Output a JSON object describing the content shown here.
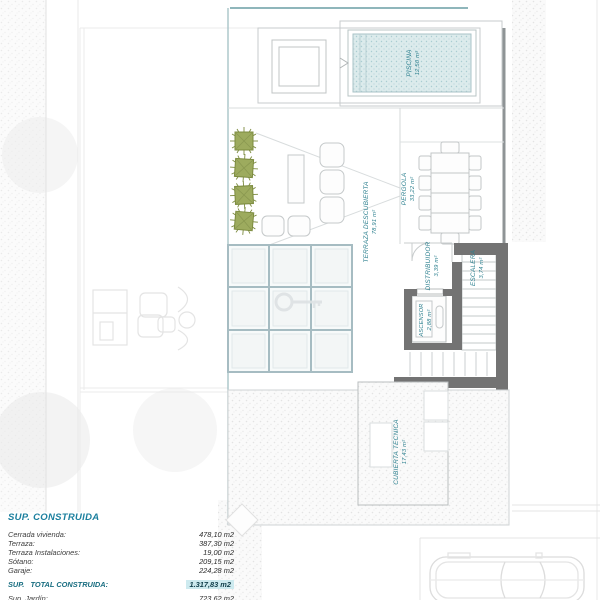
{
  "document": {
    "type": "architectural-roof-floor-plan"
  },
  "colors": {
    "accent_teal": "#1f7f93",
    "label_teal": "#2b7f8e",
    "wall_gray": "#737373",
    "plant_green": "#9aa85c",
    "pool_fill": "#dcebec",
    "total_highlight": "#cdeaef"
  },
  "plan_labels": {
    "piscina": {
      "name": "PISCINA",
      "area": "12,50 m²"
    },
    "terraza_descubierta": {
      "name": "TERRAZA DESCUBIERTA",
      "area": "78,91 m²"
    },
    "pergola": {
      "name": "PERGOLA",
      "area": "33,22 m²"
    },
    "distribuidor": {
      "name": "DISTRIBUIDOR",
      "area": "3,39 m²"
    },
    "escalera": {
      "name": "ESCALERA",
      "area": "3,74 m²"
    },
    "ascensor": {
      "name": "ASCENSOR",
      "area": "2,88 m²"
    },
    "cubierta_tecnica": {
      "name": "CUBIERTA TECNICA",
      "area": "17,43 m²"
    }
  },
  "summary": {
    "title": "SUP. CONSTRUIDA",
    "rows": [
      {
        "label": "Cerrada vivienda:",
        "value": "478,10 m2"
      },
      {
        "label": "Terraza:",
        "value": "387,30 m2"
      },
      {
        "label": "Terraza Instalaciones:",
        "value": "19,00 m2"
      },
      {
        "label": "Sótano:",
        "value": "209,15 m2"
      },
      {
        "label": "Garaje:",
        "value": "224,28 m2"
      }
    ],
    "total": {
      "label": "SUP.   TOTAL CONSTRUIDA:",
      "value": "1.317,83 m2"
    },
    "extra": [
      {
        "label": "Sup. Jardín:",
        "value": "723,62 m2"
      },
      {
        "label": "Hall Entrada Exterior:",
        "value": "63,97 m2"
      }
    ]
  }
}
